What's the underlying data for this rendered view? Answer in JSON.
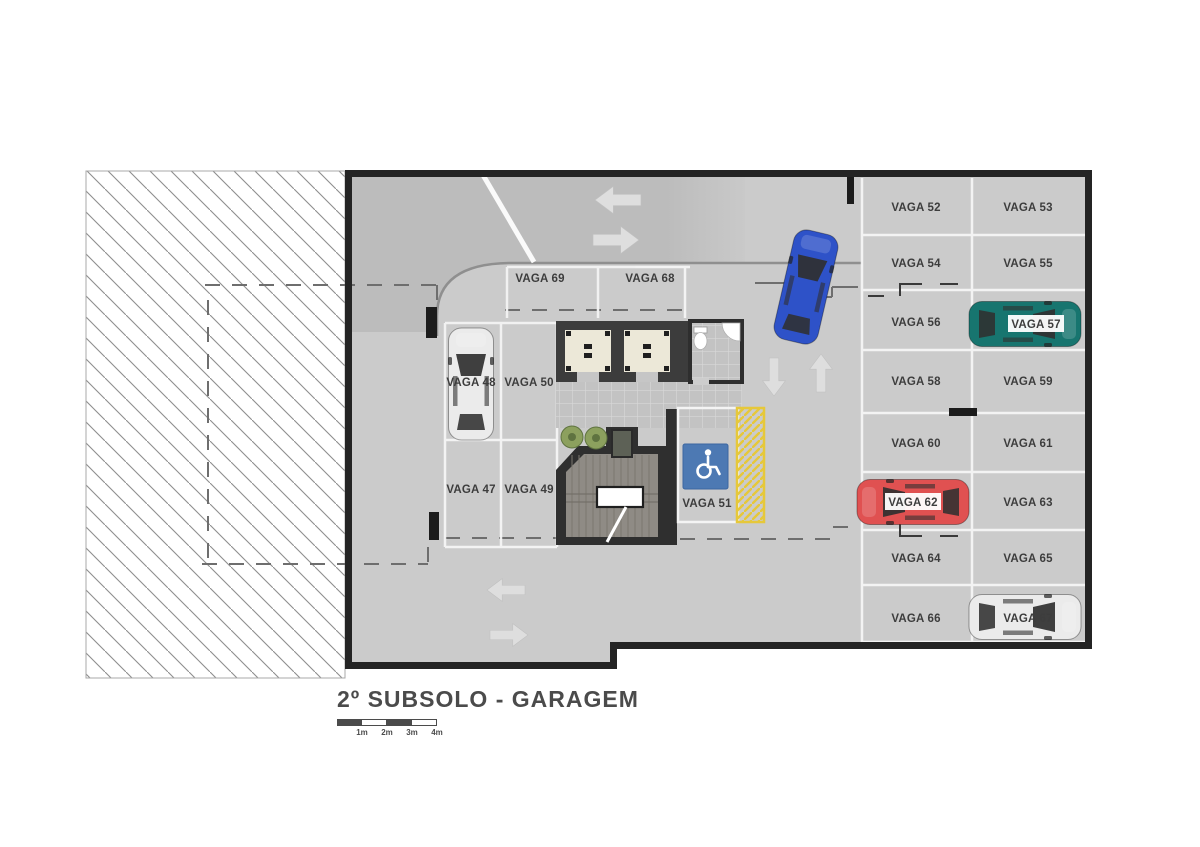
{
  "title": "2º SUBSOLO - GARAGEM",
  "scale_bar": {
    "labels": [
      "1m",
      "2m",
      "3m",
      "4m"
    ]
  },
  "spots": {
    "s47": "VAGA 47",
    "s48": "VAGA 48",
    "s49": "VAGA 49",
    "s50": "VAGA 50",
    "s51": "VAGA 51",
    "s52": "VAGA 52",
    "s53": "VAGA 53",
    "s54": "VAGA 54",
    "s55": "VAGA 55",
    "s56": "VAGA 56",
    "s57": "VAGA 57",
    "s58": "VAGA 58",
    "s59": "VAGA 59",
    "s60": "VAGA 60",
    "s61": "VAGA 61",
    "s62": "VAGA 62",
    "s63": "VAGA 63",
    "s64": "VAGA 64",
    "s65": "VAGA 65",
    "s66": "VAGA 66",
    "s67": "VAGA 67",
    "s68": "VAGA 68",
    "s69": "VAGA 69"
  },
  "colors": {
    "car_white": "#ebebeb",
    "car_blue": "#2e52c8",
    "car_teal": "#17756f",
    "car_red": "#e05151",
    "accessible_sign_blue": "#4d79b3",
    "hatch_yellow": "#e6c83a",
    "floor_gray": "#cbcbcb",
    "wall_dark": "#242424"
  }
}
